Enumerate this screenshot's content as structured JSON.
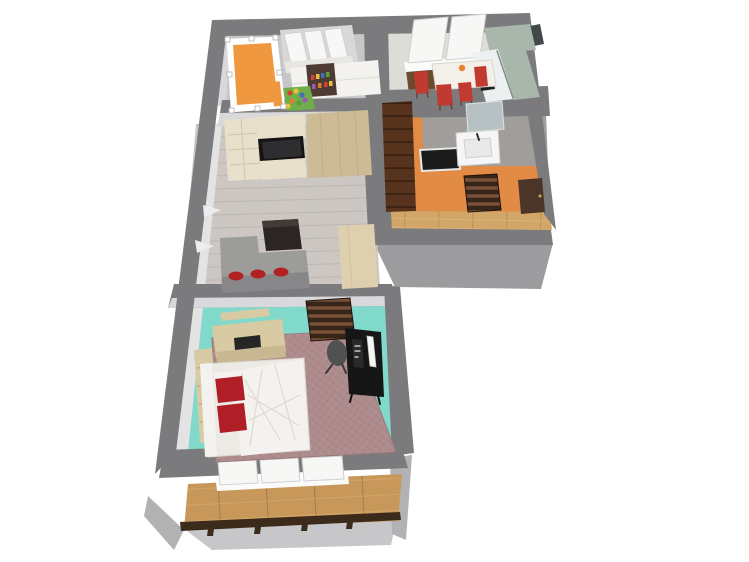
{
  "app": {
    "name": "3D floor plan render",
    "canvas": {
      "width": 749,
      "height": 562,
      "background": "#ffffff"
    },
    "selection": {
      "object": "kids-bed",
      "handles": "white squares on corners"
    }
  },
  "scene": {
    "view": "3d-floorplan-top-perspective",
    "selected_object": "kids-bed",
    "rooms": [
      {
        "name": "kids room",
        "position": "top-left",
        "floor": "gray",
        "items": [
          "orange kids bed (selected, white frame + handles)",
          "white sliding-door wardrobe",
          "toy shelf with colorful toys",
          "colorful play rug"
        ]
      },
      {
        "name": "kitchen / dining",
        "position": "top-right",
        "floor": "light with dark wood strip",
        "items": [
          "two windows",
          "white dining table with orange flowers",
          "4 red chairs",
          "sage green L-shaped counter",
          "black oven"
        ]
      },
      {
        "name": "living room",
        "position": "middle-left",
        "floor": "gray wood planks",
        "items": [
          "media wall with TV",
          "gray corner sofa with red cushions",
          "dark coffee table",
          "white wall shelves",
          "wooden side table"
        ]
      },
      {
        "name": "bathroom",
        "position": "middle-right",
        "floor": "gray",
        "items": [
          "washbasin",
          "mirror",
          "dark bathtub"
        ]
      },
      {
        "name": "hallway",
        "position": "right",
        "walls": "orange",
        "floor": "oak planks",
        "items": [
          "tall dark wardrobe cabinet",
          "slatted doormat",
          "entrance door"
        ]
      },
      {
        "name": "bedroom",
        "position": "bottom",
        "floor": "turquoise",
        "items": [
          "double bed with white duvet and red pillows",
          "patterned mauve rug",
          "wooden dresser",
          "wall shelf",
          "bookshelf",
          "black desk with monitor and PC",
          "office chair",
          "slatted doormat"
        ]
      },
      {
        "name": "balcony",
        "position": "bottom",
        "floor": "wood decking",
        "items": [
          "three windows",
          "dark wood railing"
        ]
      }
    ]
  },
  "colors": {
    "background": "#ffffff",
    "wall_top": "#7b7b7e",
    "wall_face_outer": "#9c9c9f",
    "wall_face_light": "#c7c7ca",
    "wall_side": "#b2b2b5",
    "wall_inner_white": "#e4e3e3",
    "wall_face_bright": "#d9d9db",
    "floor_nursery": "#c7c6c9",
    "floor_kitchen": "#dedcd7",
    "floor_kitchen_wood": "#6e4a2c",
    "floor_living": "#ccc7c2",
    "plank_living": "#b9b3ae",
    "floor_bath": "#a09d9a",
    "wall_hall_orange": "#e18b45",
    "floor_hall": "#d2a668",
    "plank_hall": "#b98c4e",
    "plank_hall_light": "#e6bd82",
    "floor_bedroom": "#80d9cb",
    "floor_balcony": "#c8985b",
    "plank_balcony": "#a87c45",
    "plank_balcony_light": "#d9ad6e",
    "rug_base": "#b08e8f",
    "rug_line": "#8c696a",
    "crib_orange": "#ef9840",
    "white_frame": "#ffffff",
    "wardrobe_back": "#d9d8d6",
    "wardrobe_top": "#e7e6e3",
    "wardrobe_front": "#f3f2ef",
    "toy_shelf": "#4e3c34",
    "toy_1": "#d8432f",
    "toy_2": "#3d6fb5",
    "toy_3": "#e8c23a",
    "toy_4": "#5a9e3f",
    "toy_5": "#9b59b6",
    "toy_6": "#e07b2e",
    "rug_kids": "#6fae4b",
    "counter_top": "#a9b6ab",
    "counter_front": "#edf0f0",
    "backsplash_dark": "#3f4a49",
    "appliance_dark": "#202022",
    "table_white": "#f2f0e8",
    "chair_red": "#c13a32",
    "flower_orange": "#e8842a",
    "unit_cream": "#e8e0cb",
    "unit_wood": "#cdbb96",
    "tv_black": "#141414",
    "tv_screen": "#2e2e30",
    "coffee_table": "#2b2624",
    "coffee_top": "#413a36",
    "sofa_gray": "#9c9c9a",
    "sofa_front": "#87878a",
    "cushion_red": "#b22222",
    "shelf_white": "#ededef",
    "side_table": "#decfae",
    "bed_linen": "#f4f2ee",
    "bed_side": "#eceae4",
    "crease": "#d9d5cc",
    "pillow_red": "#b01f27",
    "dresser_wood": "#d8caa3",
    "dresser_front": "#c8b892",
    "dresser_inset": "#262626",
    "desk_black": "#161616",
    "monitor_white": "#f5f5f5",
    "pc_dark": "#2a2a2c",
    "office_chair": "#515154",
    "door_mat": "#362519",
    "mat_slat": "#7a5138",
    "door_brown": "#4b3428",
    "cabinet_wood": "#57331e",
    "cabinet_line": "#3a2112",
    "railing": "#3c2a1b",
    "window_white": "#f7f7f6",
    "window_sill": "#fbfbfa",
    "mirror_glass": "#b7c1c3",
    "sink_white": "#f6f6f6",
    "sink_basin": "#e9e9e9",
    "tub_black": "#1b1b1b"
  }
}
